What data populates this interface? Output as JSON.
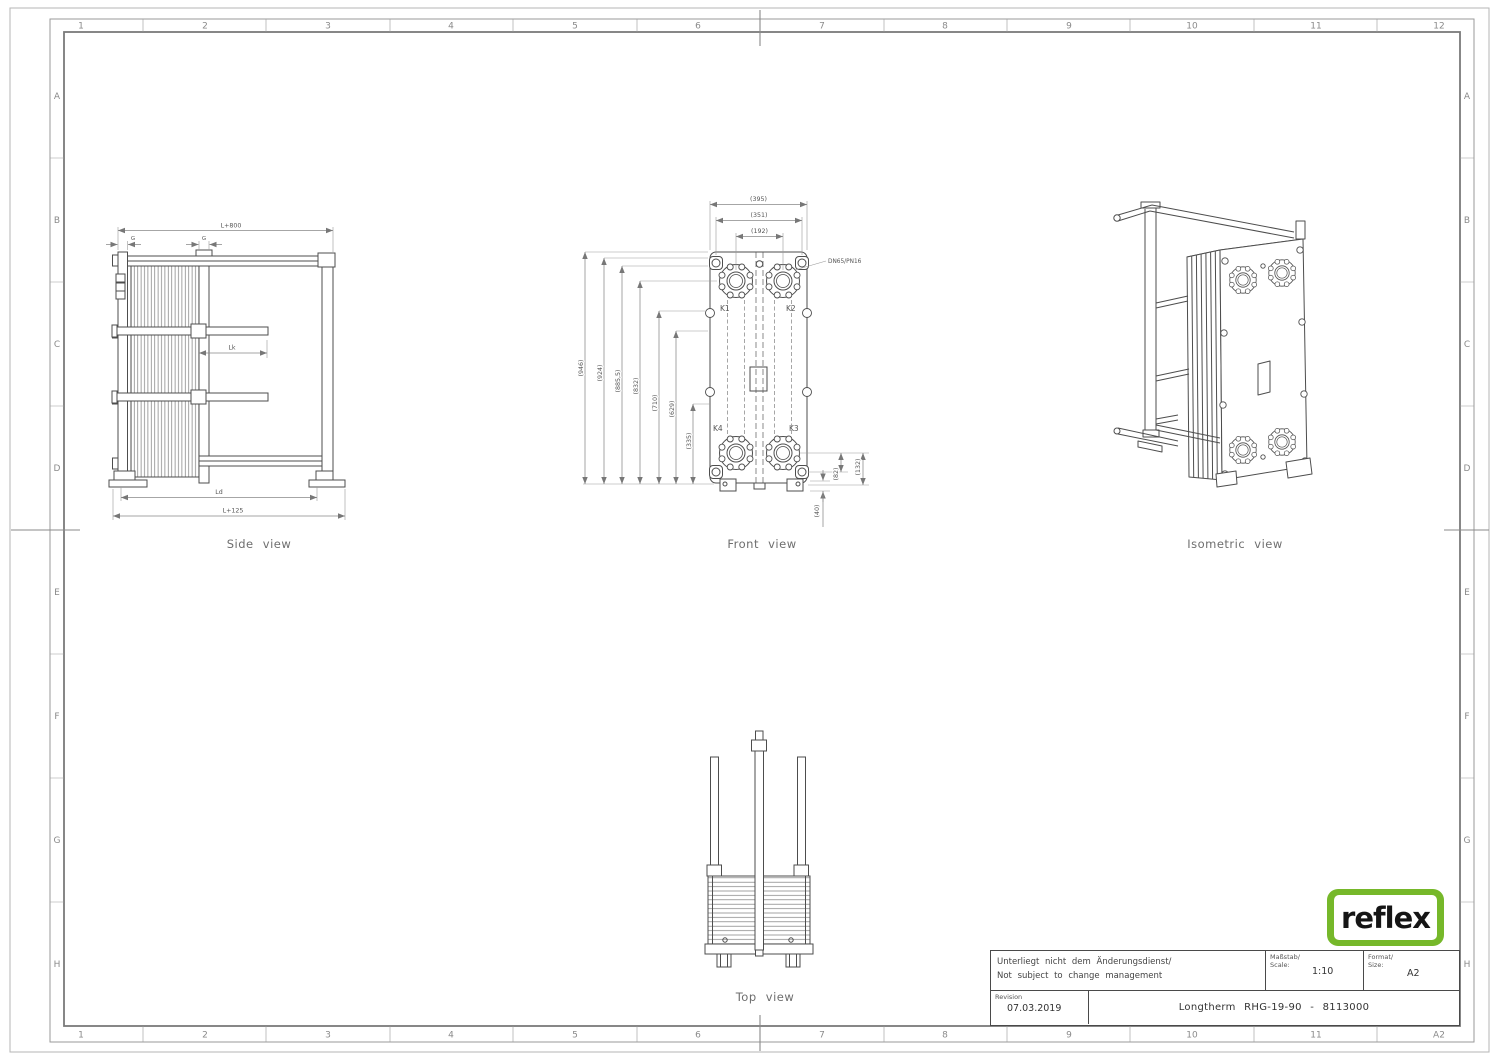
{
  "frame": {
    "top_zones": [
      "1",
      "2",
      "3",
      "4",
      "5",
      "6",
      "7",
      "8",
      "9",
      "10",
      "11",
      "12"
    ],
    "bottom_zones": [
      "1",
      "2",
      "3",
      "4",
      "5",
      "6",
      "7",
      "8",
      "9",
      "10",
      "11",
      "A2"
    ],
    "row_zones": [
      "A",
      "B",
      "C",
      "D",
      "E",
      "F",
      "G",
      "H"
    ]
  },
  "views": {
    "side": {
      "caption": "Side view",
      "dim_length_top": "L+800",
      "dim_g_left": "G",
      "dim_g_right": "G",
      "dim_lk": "Lk",
      "dim_ld": "Ld",
      "dim_total": "L+125"
    },
    "front": {
      "caption": "Front view",
      "connection_label": "DN65/PN16",
      "port_k1": "K1",
      "port_k2": "K2",
      "port_k3": "K3",
      "port_k4": "K4",
      "dim_width_outer": "(395)",
      "dim_width_holes": "(351)",
      "dim_width_ports": "(192)",
      "dims_left": [
        "(946)",
        "(924)",
        "(885,5)",
        "(832)",
        "(710)",
        "(629)",
        "(335)"
      ],
      "dim_right_inner": "(82)",
      "dim_right_outer": "(132)",
      "dim_foot": "(40)"
    },
    "isometric": {
      "caption": "Isometric view"
    },
    "top": {
      "caption": "Top view"
    }
  },
  "title_block": {
    "note_de": "Unterliegt nicht dem Änderungsdienst/",
    "note_en": "Not subject to change management",
    "scale_label_de": "Maßstab/",
    "scale_label_en": "Scale:",
    "scale_value": "1:10",
    "format_label_de": "Format/",
    "format_label_en": "Size:",
    "format_value": "A2",
    "revision_label": "Revision",
    "revision_date": "07.03.2019",
    "drawing_title": "Longtherm RHG-19-90 - 8113000",
    "logo_text": "reflex",
    "brand_color": "#76b82a"
  }
}
